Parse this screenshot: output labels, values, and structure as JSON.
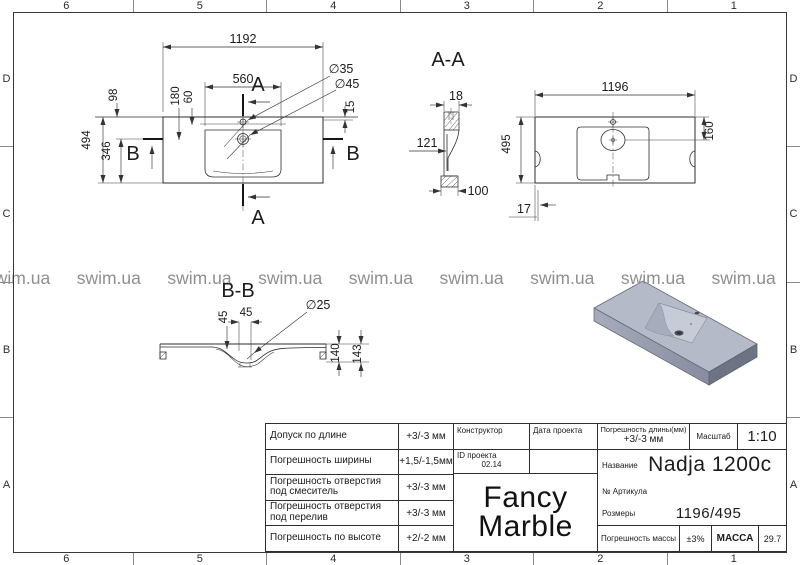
{
  "frame": {
    "columns": [
      "6",
      "5",
      "4",
      "3",
      "2",
      "1"
    ],
    "rows": [
      "D",
      "C",
      "B",
      "A"
    ]
  },
  "watermark": {
    "text": "swim.ua",
    "color": "#8f8f8f"
  },
  "plan": {
    "dim_1192": "1192",
    "dim_560": "560",
    "dim_98": "98",
    "dim_180": "180",
    "dim_60": "60",
    "dim_494": "494",
    "dim_346": "346",
    "dim_15": "15",
    "dia_35": "∅35",
    "dia_45": "∅45",
    "cut_a": "A",
    "cut_b": "B"
  },
  "section_aa": {
    "label": "A-A",
    "dim_18": "18",
    "dim_121": "121",
    "dim_100": "100"
  },
  "bottom_view": {
    "dim_1196": "1196",
    "dim_495": "495",
    "dim_160": "160",
    "dim_17": "17"
  },
  "section_bb": {
    "label": "B-B",
    "dim_45_v": "45",
    "dim_45_h": "45",
    "dia_25": "∅25",
    "dim_140": "140",
    "dim_143": "143"
  },
  "titleblock": {
    "rows": [
      {
        "label": "Допуск по длине",
        "value": "+3/-3 мм"
      },
      {
        "label": "Погрешность ширины",
        "value": "+1,5/-1,5мм"
      },
      {
        "label": "Погрешность отверстия под смеситель",
        "value": "+3/-3 мм"
      },
      {
        "label": "Погрешность отверстия под перелив",
        "value": "+3/-3 мм"
      },
      {
        "label": "Погрешность по высоте",
        "value": "+2/-2 мм"
      }
    ],
    "designer_label": "Конструктор",
    "date_label": "Дата проекта",
    "project_id_label": "ID проекта",
    "project_id_value": "02.14",
    "brand_top": "Fancy",
    "brand_bottom": "Marble",
    "len_tol_label": "Погрешность длины(мм)",
    "len_tol_value": "+3/-3 мм",
    "scale_label": "Масштаб",
    "scale_value": "1:10",
    "name_label": "Название",
    "name_value": "Nadja 1200c",
    "article_label": "№ Артикула",
    "size_label": "Розмеры",
    "size_value": "1196/495",
    "mass_tol_label": "Погрешность массы",
    "mass_tol_value": "±3%",
    "mass_label": "МАССА",
    "mass_value": "29.7"
  }
}
